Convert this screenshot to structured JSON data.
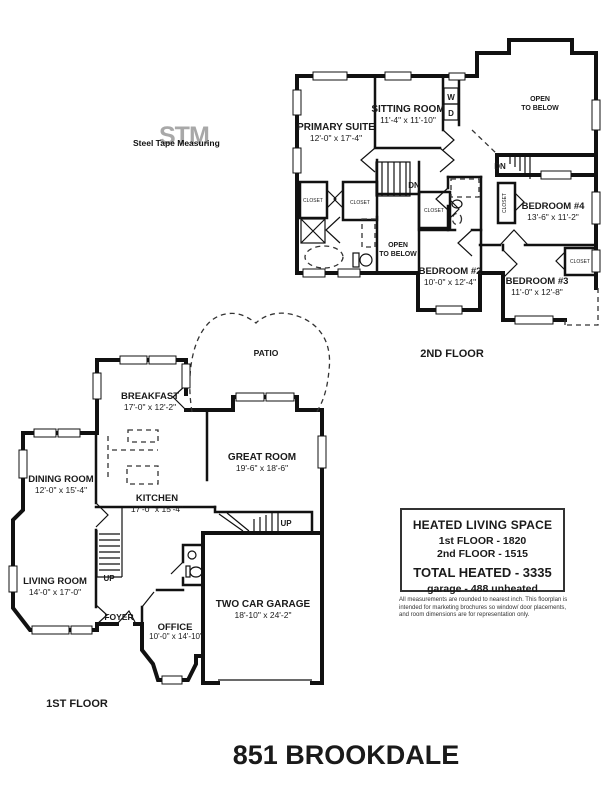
{
  "logo": {
    "watermark": "STM",
    "name": "Steel Tape Measuring"
  },
  "second_floor": {
    "floor_label": "2ND FLOOR",
    "primary_suite_name": "PRIMARY SUITE",
    "primary_suite_dims": "12'-0\" x 17'-4\"",
    "sitting_room_name": "SITTING ROOM",
    "sitting_room_dims": "11'-4\" x 11'-10\"",
    "bedroom2_name": "BEDROOM #2",
    "bedroom2_dims": "10'-0\" x 12'-4\"",
    "bedroom3_name": "BEDROOM #3",
    "bedroom3_dims": "11'-0\" x 12'-8\"",
    "bedroom4_name": "BEDROOM #4",
    "bedroom4_dims": "13'-6\" x 11'-2\"",
    "open_line1": "OPEN",
    "open_line2": "TO BELOW",
    "washer": "W",
    "dryer": "D",
    "down_label": "DN",
    "closet_label": "CLOSET"
  },
  "first_floor": {
    "floor_label": "1ST FLOOR",
    "patio": "PATIO",
    "breakfast_name": "BREAKFAST",
    "breakfast_dims": "17'-0\" x 12'-2\"",
    "dining_name": "DINING ROOM",
    "dining_dims": "12'-0\" x 15'-4\"",
    "kitchen_name": "KITCHEN",
    "kitchen_dims": "17'-0\" x 15'-4\"",
    "great_name": "GREAT ROOM",
    "great_dims": "19'-6\" x 18'-6\"",
    "living_name": "LIVING ROOM",
    "living_dims": "14'-0\" x 17'-0\"",
    "foyer": "FOYER",
    "office_name": "OFFICE",
    "office_dims": "10'-0\" x 14'-10\"",
    "garage_name": "TWO CAR GARAGE",
    "garage_dims": "18'-10\" x 24'-2\"",
    "up_label": "UP"
  },
  "info_box": {
    "title": "HEATED LIVING SPACE",
    "first_floor": "1st FLOOR - 1820",
    "second_floor": "2nd FLOOR - 1515",
    "total": "TOTAL HEATED - 3335",
    "garage": "garage - 488 unheated",
    "disclaimer_line1": "All measurements are rounded to nearest inch. This floorplan is",
    "disclaimer_line2": "intended for marketing brochures so window/ door placements,",
    "disclaimer_line3": "and room dimensions are for representation only."
  },
  "title": "851 BROOKDALE"
}
